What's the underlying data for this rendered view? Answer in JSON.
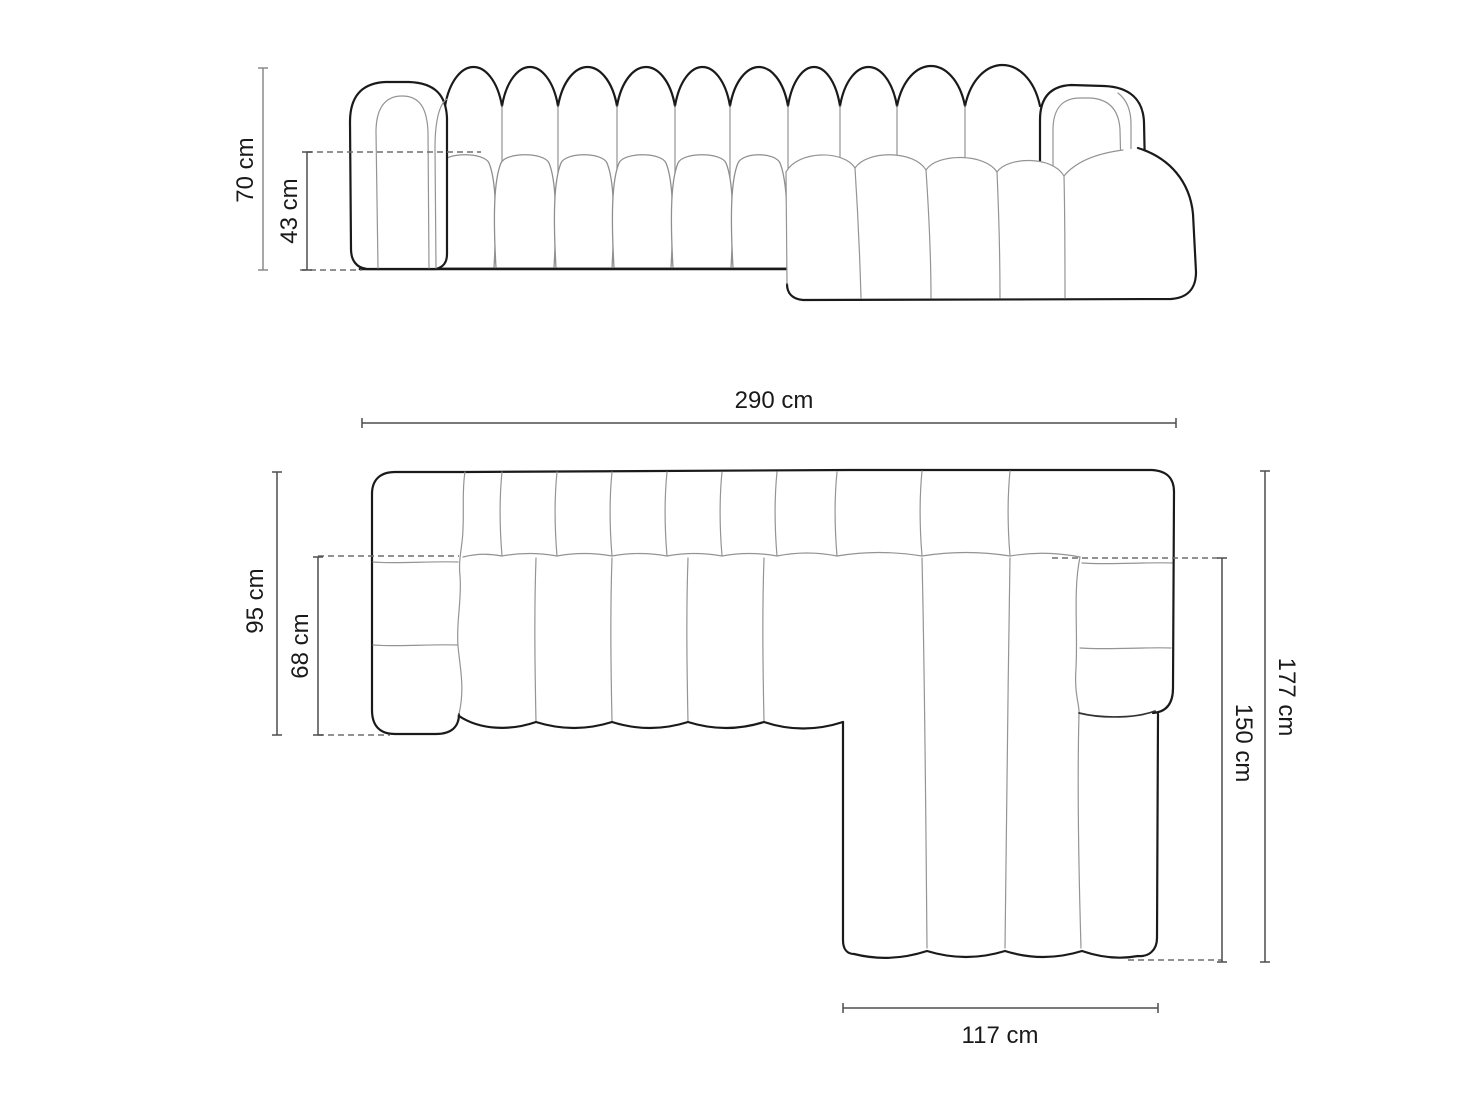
{
  "diagram": {
    "front_view": {
      "total_height": "70 cm",
      "seat_height": "43 cm"
    },
    "top_view": {
      "total_width": "290 cm",
      "side_depth": "95 cm",
      "seat_depth": "68 cm",
      "overall_depth": "177 cm",
      "chaise_depth": "150 cm",
      "chaise_width": "117 cm"
    },
    "colors": {
      "background": "#ffffff",
      "outline": "#1a1a1a",
      "seam": "#949494",
      "dimension_line": "#4d4d4d",
      "dimension_line_light": "#8a8a8a",
      "dashed_line": "#6e6e6e",
      "label_text": "#1a1a1a"
    }
  }
}
